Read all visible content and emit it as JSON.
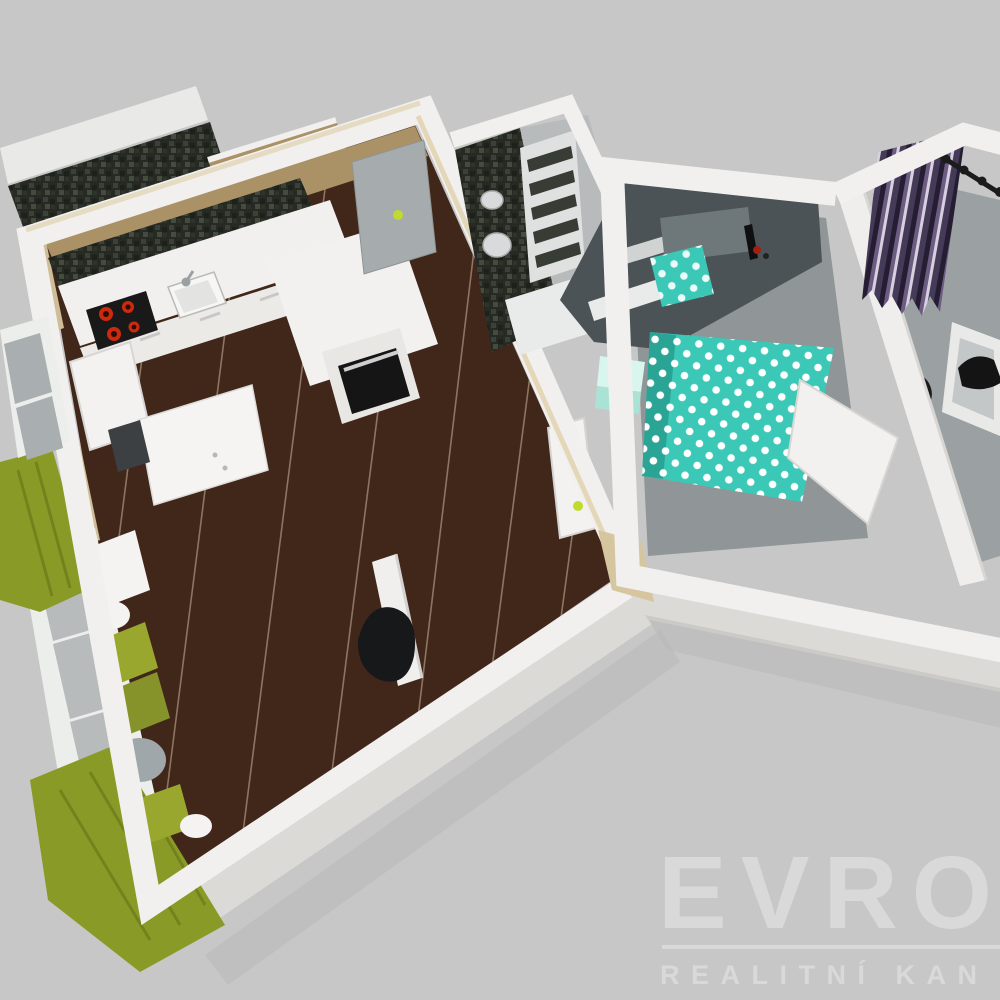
{
  "watermark": {
    "brand": "EVRO",
    "subtitle": "REALITNÍ KAN"
  },
  "colors": {
    "background": "#c7c7c7",
    "wall_white": "#f1f0ee",
    "wall_face": "#dcdad6",
    "wall_cap_beige": "#e3d7b8",
    "wall_tan": "#ab9166",
    "wall_beige": "#cfbd97",
    "floor_wood": "#41261a",
    "plank_line": "#d9c4a8",
    "tile_gray": "#b7bbbc",
    "bath_white": "#e9eaea",
    "accent_gray": "#4b5356",
    "mirror_gray": "#6e777a",
    "bedroom_floor": "#909697",
    "closet_floor": "#9ba1a2",
    "bed_teal": "#3bc8b7",
    "bed_teal_dark": "#2aa495",
    "dot_white": "#ffffff",
    "mint_top": "#d8f5ee",
    "mint_front": "#abe2d6",
    "sofa_green": "#9aa72f",
    "sofa_green_dark": "#86922a",
    "curtain_olive": "#8a9a26",
    "pouf_gray": "#a0a7ab",
    "cushion_white": "#f4f3f1",
    "rod_black": "#1b1b1b",
    "door_gray": "#a6abad",
    "label_green": "#c0da2f",
    "cooktop_black": "#191919",
    "burner_red": "#cd2a0d",
    "oven_black": "#151515",
    "oven_handle": "#cfcfcf",
    "desk_white": "#f5f4f2",
    "chair_dark": "#3c4043",
    "black_object": "#17181a",
    "shadow": "#b5b5b5",
    "watermark": "#d9d9d9"
  }
}
